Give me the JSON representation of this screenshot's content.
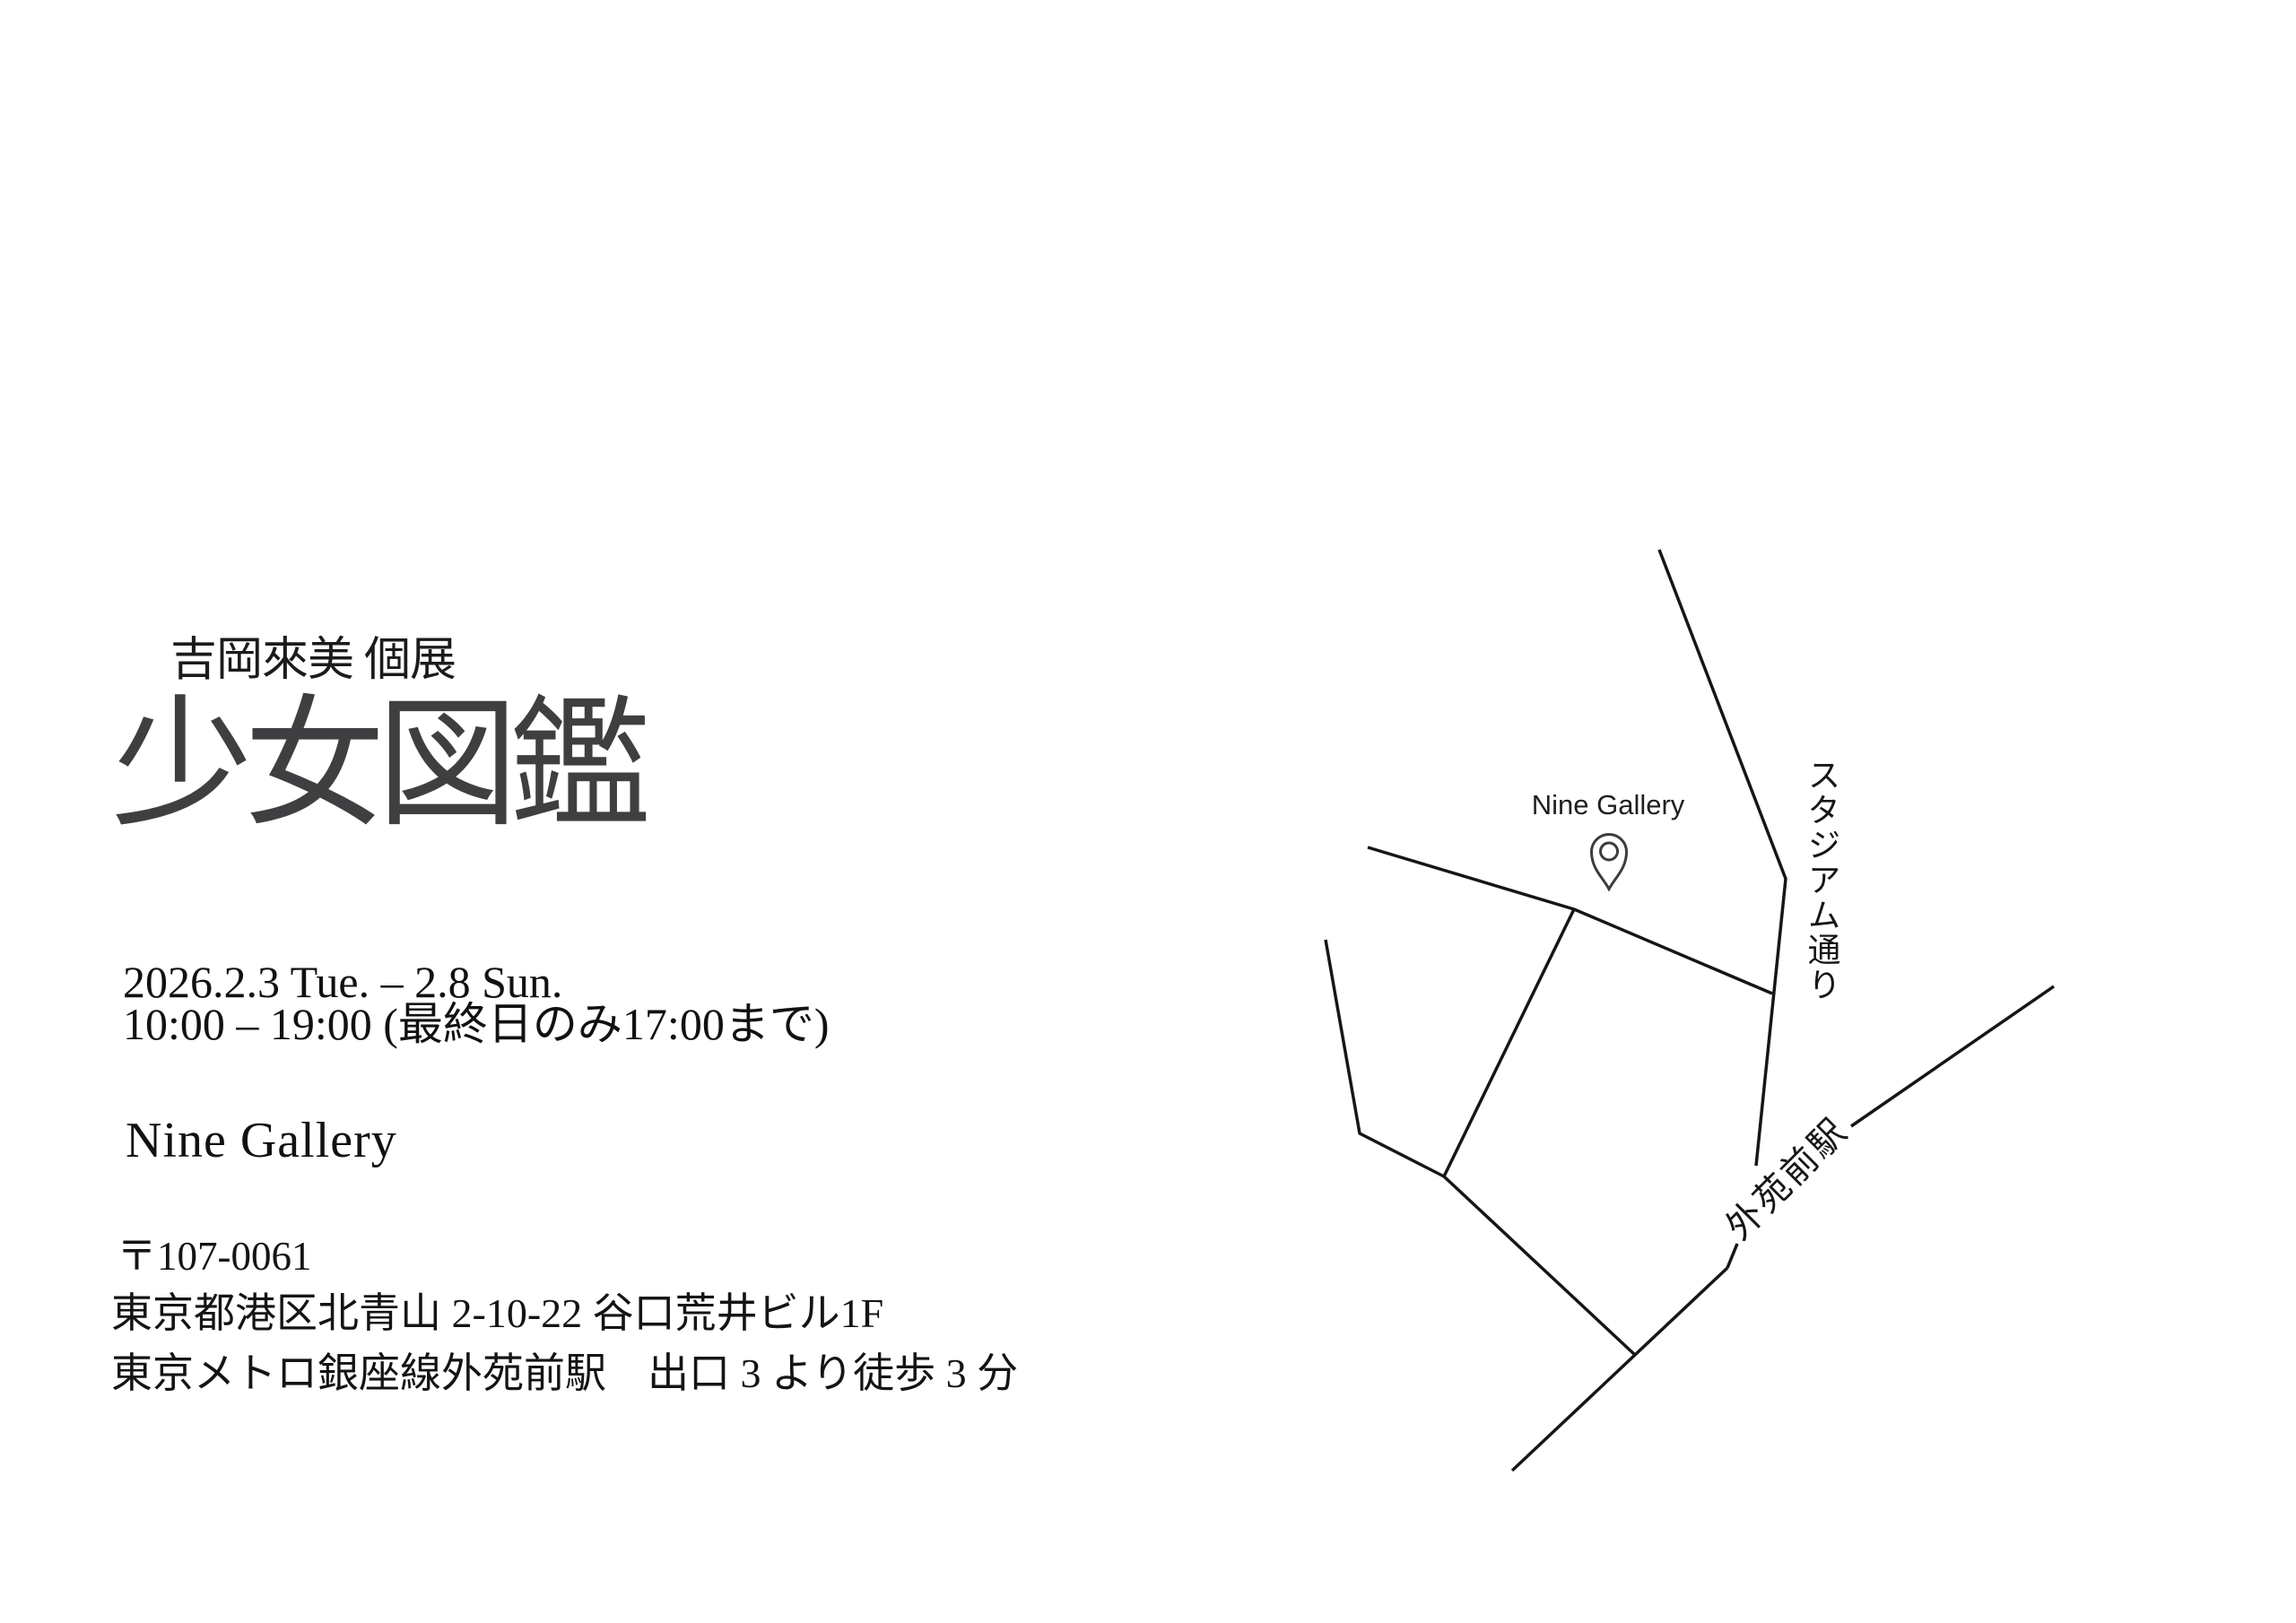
{
  "header": {
    "subtitle": "吉岡來美 個展",
    "title": "少女図鑑"
  },
  "details": {
    "date_line": "2026.2.3 Tue. – 2.8 Sun.",
    "time_line": "10:00 – 19:00 (最終日のみ17:00まで)",
    "venue": "Nine Gallery",
    "postal": "〒107-0061",
    "address": "東京都港区北青山 2-10-22 谷口荒井ビル1F",
    "access": "東京メトロ銀座線外苑前駅　出口 3 より徒歩 3 分"
  },
  "map": {
    "gallery_label": "Nine Gallery",
    "street_label_vertical": "スタジアム通り",
    "station_label": "外苑前駅",
    "pin_icon": "map-pin-icon",
    "line_color": "#161616",
    "line_width": 3.5,
    "roads": [
      {
        "name": "stadium-street-upper",
        "points": [
          [
            1850,
            613
          ],
          [
            1991,
            980
          ],
          [
            1958,
            1300
          ]
        ]
      },
      {
        "name": "stadium-street-stub",
        "points": [
          [
            1937,
            1387
          ],
          [
            1926,
            1414
          ]
        ]
      },
      {
        "name": "railway-upper",
        "points": [
          [
            2064,
            1256
          ],
          [
            2290,
            1100
          ]
        ]
      },
      {
        "name": "railway-lower",
        "points": [
          [
            1686,
            1640
          ],
          [
            1926,
            1414
          ]
        ]
      },
      {
        "name": "gallery-street",
        "points": [
          [
            1525,
            945
          ],
          [
            1755,
            1014
          ],
          [
            1976,
            1108
          ]
        ]
      },
      {
        "name": "branch-street",
        "points": [
          [
            1755,
            1014
          ],
          [
            1610,
            1312
          ]
        ]
      },
      {
        "name": "west-street",
        "points": [
          [
            1478,
            1048
          ],
          [
            1516,
            1264
          ],
          [
            1610,
            1312
          ],
          [
            1823,
            1511
          ]
        ]
      }
    ]
  },
  "colors": {
    "title_gray": "#3f3f42",
    "text_black": "#141414",
    "map_line": "#161616",
    "background": "#ffffff"
  }
}
